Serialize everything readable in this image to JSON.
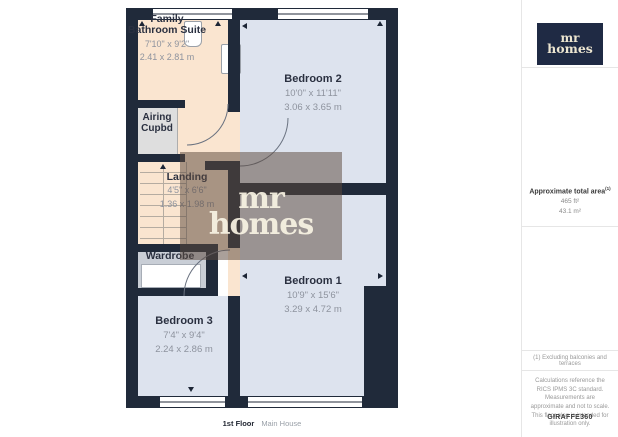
{
  "floorplan": {
    "rooms": {
      "bathroom": {
        "name": "Family Bathroom Suite",
        "dims_ft": "7'10\" x 9'2\"",
        "dims_m": "2.41 x 2.81 m"
      },
      "airing": {
        "name": "Airing Cupbd"
      },
      "landing": {
        "name": "Landing",
        "dims_ft": "4'5\" x 6'6\"",
        "dims_m": "1.36 x 1.98 m"
      },
      "wardrobe": {
        "name": "Wardrobe"
      },
      "bedroom2": {
        "name": "Bedroom 2",
        "dims_ft": "10'0\" x 11'11\"",
        "dims_m": "3.06 x 3.65 m"
      },
      "bedroom1": {
        "name": "Bedroom 1",
        "dims_ft": "10'9\" x 15'6\"",
        "dims_m": "3.29 x 4.72 m"
      },
      "bedroom3": {
        "name": "Bedroom 3",
        "dims_ft": "7'4\" x 9'4\"",
        "dims_m": "2.24 x 2.86 m"
      }
    },
    "footer": {
      "floor": "1st Floor",
      "building": "Main House"
    },
    "watermark": {
      "line1": "mr",
      "line2": "homes"
    }
  },
  "sidebar": {
    "logo": {
      "line1": "mr",
      "line2": "homes"
    },
    "area": {
      "heading": "Approximate total area",
      "note_marker": "(1)",
      "value_ft": "465 ft²",
      "value_m": "43.1 m²"
    },
    "footnote": "(1) Excluding balconies and terraces",
    "disclaimer": "Calculations reference the RICS IPMS 3C standard. Measurements are approximate and not to scale. This floor plan is intended for illustration only.",
    "brand": "GIRAFFE360"
  },
  "colors": {
    "wall": "#202a3a",
    "bedroom_fill": "#dde3ee",
    "hall_fill": "#fae5d0",
    "cupboard_fill": "#dedede",
    "wardrobe_fill": "#c9ced6",
    "logo_navy": "#1f2a44",
    "logo_cream": "#ece5d0",
    "watermark_overlay": "rgba(92,73,62,0.52)"
  }
}
